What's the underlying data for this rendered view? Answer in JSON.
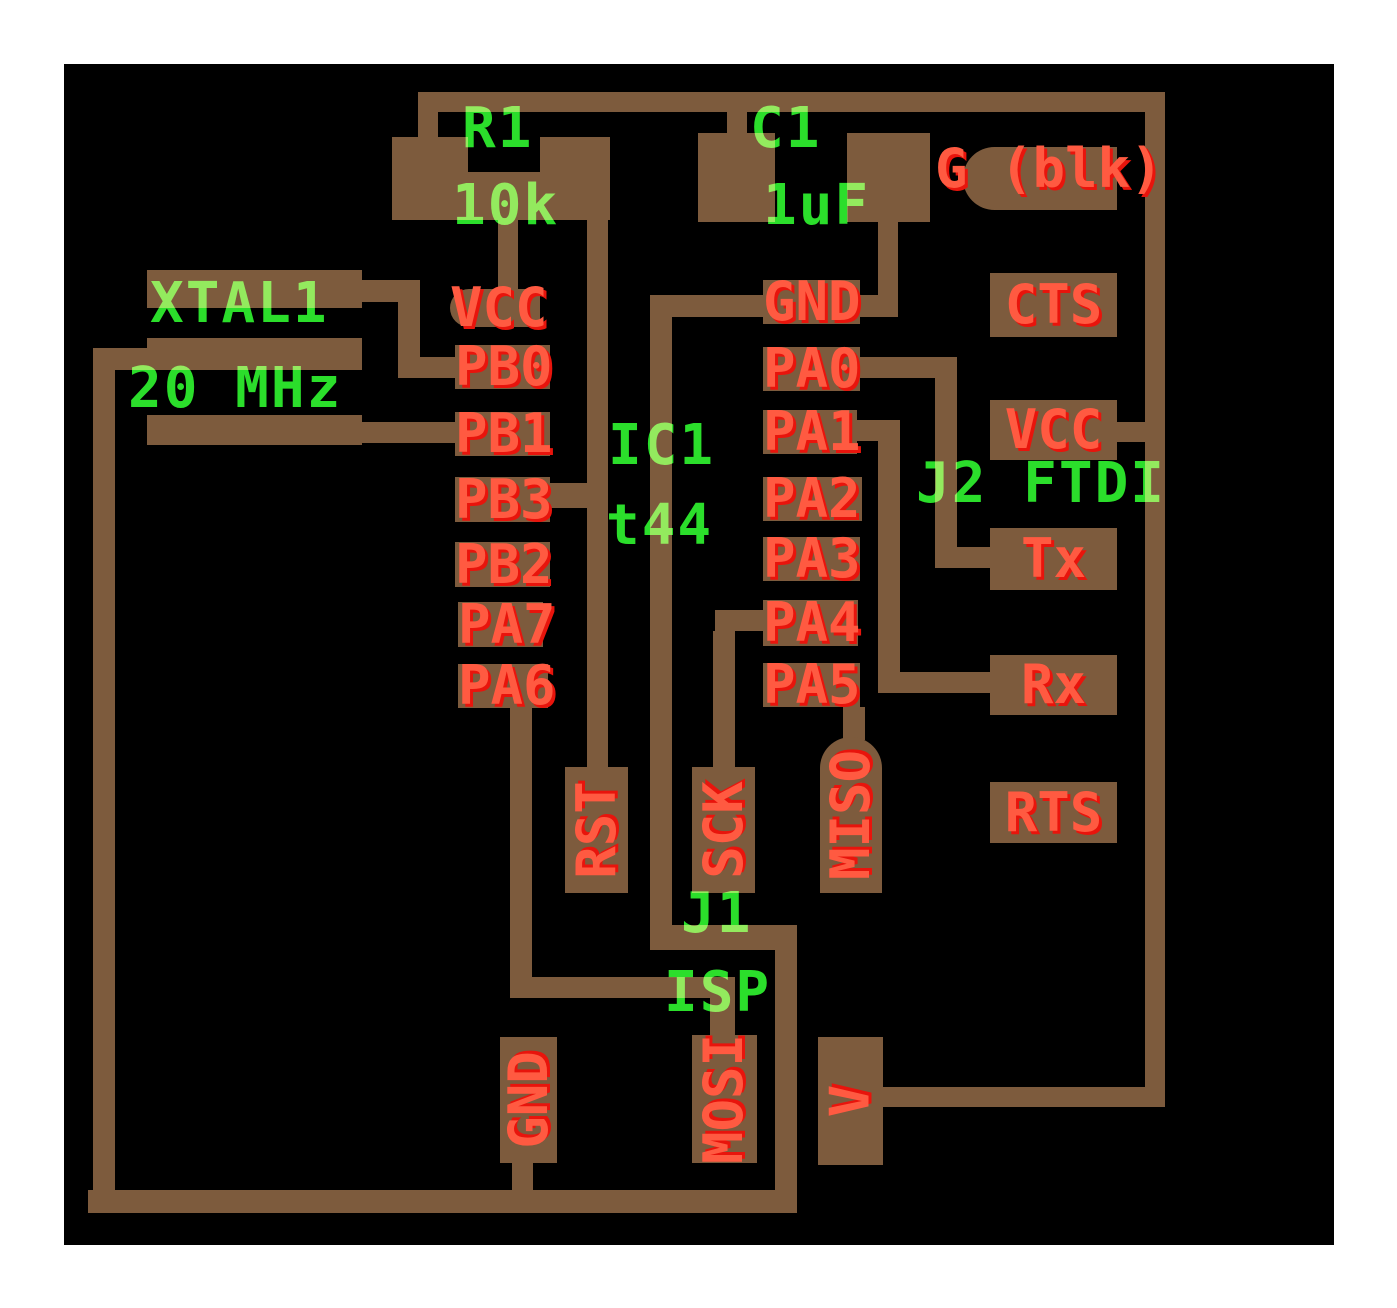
{
  "title": "PCB layout - ATtiny44 FTDI board",
  "colors": {
    "board_background": "#000000",
    "page_margin": "#ffffff",
    "copper": "#7d5b3d",
    "pin_label_red": "#ff5a41",
    "pin_label_red_shadow": "#e8140c",
    "silkscreen_green": "#2bde2b"
  },
  "components": {
    "r1_ref": "R1",
    "r1_value": "10k",
    "c1_ref": "C1",
    "c1_value": "1uF",
    "xtal_ref": "XTAL1",
    "xtal_value": "20 MHz",
    "ic_ref": "IC1",
    "ic_value": "t44",
    "j1_ref": "J1",
    "j1_value": "ISP",
    "j2_ref": "J2 FTDI",
    "j2_aux_label": "G (blk)"
  },
  "ic_pins_left": [
    "VCC",
    "PB0",
    "PB1",
    "PB3",
    "PB2",
    "PA7",
    "PA6"
  ],
  "ic_pins_right": [
    "GND",
    "PA0",
    "PA1",
    "PA2",
    "PA3",
    "PA4",
    "PA5"
  ],
  "j1_pins": [
    "RST",
    "SCK",
    "MISO",
    "GND",
    "MOSI",
    "V"
  ],
  "j2_pins": [
    "CTS",
    "VCC",
    "Tx",
    "Rx",
    "RTS"
  ],
  "nets": [
    "VCC",
    "GND",
    "RST",
    "XTAL-PB0",
    "XTAL-PB1",
    "PA0-TX",
    "PA1-RX",
    "PA4-SCK",
    "PA5-MISO",
    "PA6-MOSI"
  ]
}
